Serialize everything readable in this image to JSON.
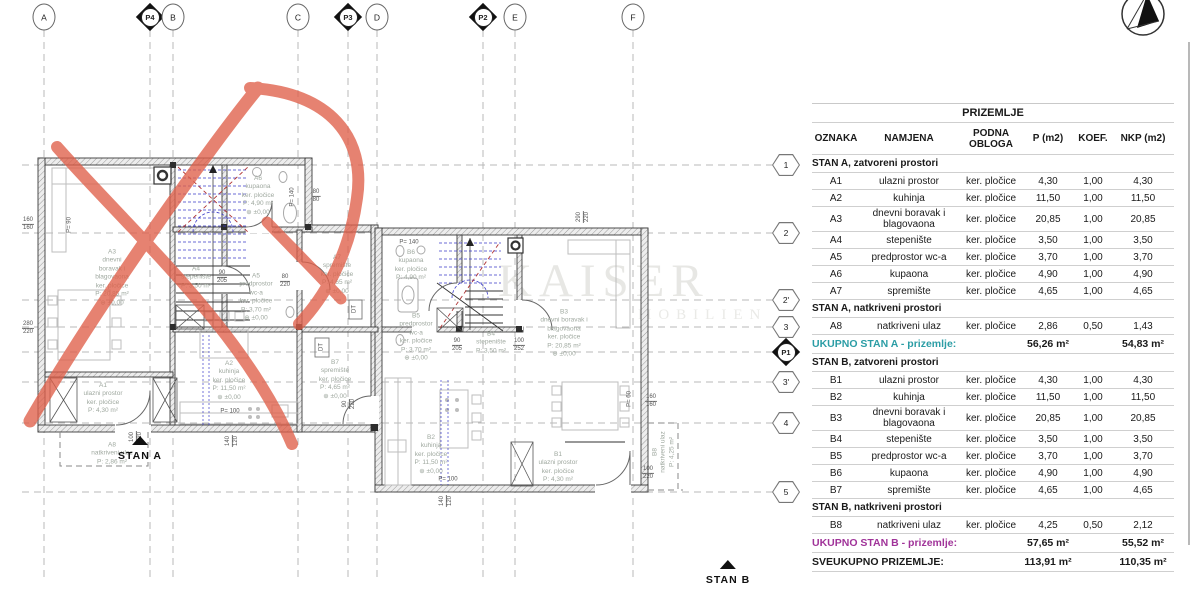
{
  "colors": {
    "teal": "#2B9DA5",
    "magenta": "#A03399",
    "red_marker": "#E0604A",
    "stair_blue": "#3B3BC8",
    "section_red": "#B03434"
  },
  "watermark": {
    "line1": "KAISER",
    "line2": "MOBILIEN"
  },
  "table": {
    "title": "PRIZEMLJE",
    "columns": [
      "OZNAKA",
      "NAMJENA",
      "PODNA OBLOGA",
      "P (m2)",
      "KOEF.",
      "NKP (m2)"
    ],
    "rows": [
      {
        "type": "section",
        "label": "STAN A, zatvoreni prostori"
      },
      {
        "type": "data",
        "oznaka": "A1",
        "namjena": "ulazni prostor",
        "obloga": "ker. pločice",
        "p": "4,30",
        "koef": "1,00",
        "nkp": "4,30"
      },
      {
        "type": "data",
        "oznaka": "A2",
        "namjena": "kuhinja",
        "obloga": "ker. pločice",
        "p": "11,50",
        "koef": "1,00",
        "nkp": "11,50"
      },
      {
        "type": "data",
        "oznaka": "A3",
        "namjena": "dnevni boravak i blagovaona",
        "obloga": "ker. pločice",
        "p": "20,85",
        "koef": "1,00",
        "nkp": "20,85"
      },
      {
        "type": "data",
        "oznaka": "A4",
        "namjena": "stepenište",
        "obloga": "ker. pločice",
        "p": "3,50",
        "koef": "1,00",
        "nkp": "3,50"
      },
      {
        "type": "data",
        "oznaka": "A5",
        "namjena": "predprostor wc-a",
        "obloga": "ker. pločice",
        "p": "3,70",
        "koef": "1,00",
        "nkp": "3,70"
      },
      {
        "type": "data",
        "oznaka": "A6",
        "namjena": "kupaona",
        "obloga": "ker. pločice",
        "p": "4,90",
        "koef": "1,00",
        "nkp": "4,90"
      },
      {
        "type": "data",
        "oznaka": "A7",
        "namjena": "spremište",
        "obloga": "ker. pločice",
        "p": "4,65",
        "koef": "1,00",
        "nkp": "4,65"
      },
      {
        "type": "section",
        "label": "STAN A, natkriveni prostori"
      },
      {
        "type": "data",
        "oznaka": "A8",
        "namjena": "natkriveni ulaz",
        "obloga": "ker. pločice",
        "p": "2,86",
        "koef": "0,50",
        "nkp": "1,43"
      },
      {
        "type": "total",
        "color": "teal",
        "label": "UKUPNO STAN A - prizemlje:",
        "p": "56,26 m²",
        "nkp": "54,83 m²"
      },
      {
        "type": "section",
        "label": "STAN B, zatvoreni prostori"
      },
      {
        "type": "data",
        "oznaka": "B1",
        "namjena": "ulazni prostor",
        "obloga": "ker. pločice",
        "p": "4,30",
        "koef": "1,00",
        "nkp": "4,30"
      },
      {
        "type": "data",
        "oznaka": "B2",
        "namjena": "kuhinja",
        "obloga": "ker. pločice",
        "p": "11,50",
        "koef": "1,00",
        "nkp": "11,50"
      },
      {
        "type": "data",
        "oznaka": "B3",
        "namjena": "dnevni boravak i blagovaona",
        "obloga": "ker. pločice",
        "p": "20,85",
        "koef": "1,00",
        "nkp": "20,85"
      },
      {
        "type": "data",
        "oznaka": "B4",
        "namjena": "stepenište",
        "obloga": "ker. pločice",
        "p": "3,50",
        "koef": "1,00",
        "nkp": "3,50"
      },
      {
        "type": "data",
        "oznaka": "B5",
        "namjena": "predprostor wc-a",
        "obloga": "ker. pločice",
        "p": "3,70",
        "koef": "1,00",
        "nkp": "3,70"
      },
      {
        "type": "data",
        "oznaka": "B6",
        "namjena": "kupaona",
        "obloga": "ker. pločice",
        "p": "4,90",
        "koef": "1,00",
        "nkp": "4,90"
      },
      {
        "type": "data",
        "oznaka": "B7",
        "namjena": "spremište",
        "obloga": "ker. pločice",
        "p": "4,65",
        "koef": "1,00",
        "nkp": "4,65"
      },
      {
        "type": "section",
        "label": "STAN B, natkriveni prostori"
      },
      {
        "type": "data",
        "oznaka": "B8",
        "namjena": "natkriveni ulaz",
        "obloga": "ker. pločice",
        "p": "4,25",
        "koef": "0,50",
        "nkp": "2,12"
      },
      {
        "type": "total",
        "color": "magenta",
        "label": "UKUPNO STAN B - prizemlje:",
        "p": "57,65 m²",
        "nkp": "55,52 m²"
      },
      {
        "type": "total",
        "color": "black",
        "label": "SVEUKUPNO PRIZEMLJE:",
        "p": "113,91 m²",
        "nkp": "110,35 m²"
      }
    ]
  },
  "plan": {
    "axis_top": [
      {
        "label": "A",
        "x": 44,
        "shape": "circle"
      },
      {
        "label": "P4",
        "x": 150,
        "shape": "diamond"
      },
      {
        "label": "B",
        "x": 173,
        "shape": "circle"
      },
      {
        "label": "C",
        "x": 298,
        "shape": "circle"
      },
      {
        "label": "P3",
        "x": 348,
        "shape": "diamond"
      },
      {
        "label": "D",
        "x": 377,
        "shape": "circle"
      },
      {
        "label": "P2",
        "x": 483,
        "shape": "diamond"
      },
      {
        "label": "E",
        "x": 515,
        "shape": "circle"
      },
      {
        "label": "F",
        "x": 633,
        "shape": "circle"
      }
    ],
    "axis_right": [
      {
        "label": "1",
        "y": 165,
        "shape": "hex"
      },
      {
        "label": "2",
        "y": 233,
        "shape": "hex"
      },
      {
        "label": "2'",
        "y": 300,
        "shape": "hex"
      },
      {
        "label": "3",
        "y": 327,
        "shape": "hex"
      },
      {
        "label": "P1",
        "y": 352,
        "shape": "diamond"
      },
      {
        "label": "3'",
        "y": 382,
        "shape": "hex"
      },
      {
        "label": "4",
        "y": 423,
        "shape": "hex"
      },
      {
        "label": "5",
        "y": 492,
        "shape": "hex"
      }
    ],
    "rooms": [
      {
        "x": 112,
        "y": 278,
        "lines": [
          "A3",
          "dnevni",
          "boravak i",
          "blagovaona",
          "ker. pločice",
          "P: 20,85 m²",
          "⊕ ±0,00"
        ]
      },
      {
        "x": 258,
        "y": 196,
        "lines": [
          "A6",
          "kupaona",
          "ker. pločice",
          "P: 4,90 m²",
          "⊕ ±0,00"
        ]
      },
      {
        "x": 196,
        "y": 278,
        "lines": [
          "A4",
          "stepenište",
          "P: 3,50 m²"
        ]
      },
      {
        "x": 256,
        "y": 298,
        "lines": [
          "A5",
          "predprostor",
          "wc-a",
          "ker. pločice",
          "P: 3,70 m²",
          "⊕ ±0,00"
        ]
      },
      {
        "x": 337,
        "y": 275,
        "lines": [
          "A7",
          "spremište",
          "ker. pločice",
          "P: 4,65 m²",
          "⊕ ±0,00"
        ]
      },
      {
        "x": 229,
        "y": 381,
        "lines": [
          "A2",
          "kuhinja",
          "ker. pločice",
          "P: 11,50 m²",
          "⊕ ±0,00"
        ]
      },
      {
        "x": 103,
        "y": 399,
        "lines": [
          "A1",
          "ulazni prostor",
          "ker. pločice",
          "P: 4,30 m²"
        ]
      },
      {
        "x": 112,
        "y": 454,
        "lines": [
          "A8",
          "natkriveni ulaz",
          "P: 2,86 m²"
        ]
      },
      {
        "x": 411,
        "y": 266,
        "lines": [
          "B6",
          "kupaona",
          "ker. pločice",
          "P: 4,90 m²"
        ]
      },
      {
        "x": 416,
        "y": 338,
        "lines": [
          "B5",
          "predprostor",
          "wc-a",
          "ker. pločice",
          "P: 3,70 m²",
          "⊕ ±0,00"
        ]
      },
      {
        "x": 491,
        "y": 343,
        "lines": [
          "B4",
          "stepenište",
          "P: 3,50 m²"
        ]
      },
      {
        "x": 564,
        "y": 334,
        "lines": [
          "B3",
          "dnevni boravak i",
          "blagovaona",
          "ker. pločice",
          "P: 20,85 m²",
          "⊕ ±0,00"
        ]
      },
      {
        "x": 431,
        "y": 455,
        "lines": [
          "B2",
          "kuhinja",
          "ker. pločice",
          "P: 11,50 m²",
          "⊕ ±0,00"
        ]
      },
      {
        "x": 558,
        "y": 468,
        "lines": [
          "B1",
          "ulazni prostor",
          "ker. pločice",
          "P: 4,30 m²"
        ]
      },
      {
        "x": 664,
        "y": 452,
        "rot": true,
        "lines": [
          "B8",
          "natkriveni ulaz",
          "P: 4,25 m²"
        ]
      },
      {
        "x": 335,
        "y": 380,
        "lines": [
          "B7",
          "spremište",
          "ker. pločice",
          "P: 4,65 m²",
          "⊕ ±0,00"
        ]
      }
    ],
    "dims": [
      {
        "x": 28,
        "y": 224,
        "top": "160",
        "bot": "160"
      },
      {
        "x": 28,
        "y": 328,
        "top": "280",
        "bot": "220"
      },
      {
        "x": 316,
        "y": 196,
        "top": "80",
        "bot": "80"
      },
      {
        "x": 222,
        "y": 277,
        "top": "90",
        "bot": "205"
      },
      {
        "x": 285,
        "y": 281,
        "top": "80",
        "bot": "220"
      },
      {
        "x": 457,
        "y": 345,
        "top": "90",
        "bot": "205"
      },
      {
        "x": 519,
        "y": 345,
        "top": "100",
        "bot": "252"
      },
      {
        "x": 651,
        "y": 401,
        "top": "160",
        "bot": "160"
      },
      {
        "x": 648,
        "y": 473,
        "top": "100",
        "bot": "220"
      },
      {
        "x": 349,
        "y": 404,
        "rot": true,
        "top": "90",
        "bot": "220"
      },
      {
        "x": 136,
        "y": 437,
        "rot": true,
        "top": "100",
        "bot": "220"
      },
      {
        "x": 232,
        "y": 441,
        "rot": true,
        "top": "140",
        "bot": "120"
      },
      {
        "x": 446,
        "y": 501,
        "rot": true,
        "top": "140",
        "bot": "120"
      },
      {
        "x": 583,
        "y": 217,
        "rot": true,
        "top": "290",
        "bot": "220"
      },
      {
        "x": 70,
        "y": 225,
        "text": "P= 90",
        "rot": true
      },
      {
        "x": 293,
        "y": 197,
        "text": "P= 140",
        "rot": true
      },
      {
        "x": 409,
        "y": 243,
        "text": "P= 140"
      },
      {
        "x": 230,
        "y": 412,
        "text": "P= 100"
      },
      {
        "x": 448,
        "y": 480,
        "text": "P= 100"
      },
      {
        "x": 630,
        "y": 399,
        "text": "P= 60",
        "rot": true
      },
      {
        "x": 322,
        "y": 347,
        "text": "DT",
        "rot": true
      },
      {
        "x": 355,
        "y": 309,
        "text": "DT",
        "rot": true
      }
    ],
    "unit_labels": [
      {
        "x": 140,
        "y": 436,
        "text": "STAN A"
      },
      {
        "x": 728,
        "y": 560,
        "text": "STAN B"
      }
    ]
  }
}
